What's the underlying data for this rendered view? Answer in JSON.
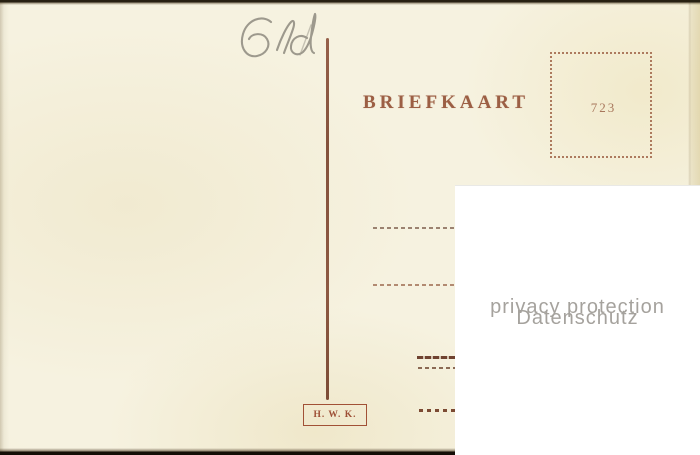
{
  "postcard": {
    "handwritten_note": "6ld",
    "title": "BRIEFKAART",
    "stamp_box": {
      "number": "723"
    },
    "publisher_mark": "H. W. K.",
    "colors": {
      "print_ink": "#9c5f44",
      "card_background": "#f5f1dd",
      "card_edge_dark": "#272012"
    }
  },
  "watermark": {
    "line1": "privacy protection",
    "line2": "Datenschutz",
    "color": "#a5a29d",
    "background": "#ffffff"
  }
}
